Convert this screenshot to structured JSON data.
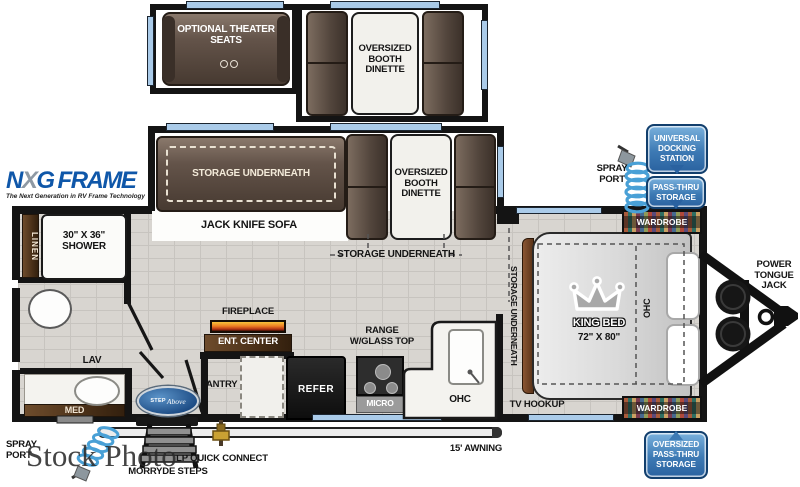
{
  "watermark": "Stock Photo",
  "brand": {
    "nxg_n": "N",
    "nxg_x": "X",
    "nxg_g": "G",
    "nxg_frame": "FRAME",
    "nxg_tagline": "The Next Generation in RV Frame Technology",
    "step": "STEP",
    "above": "Above",
    "colors": {
      "nxg_blue": "#0f57a9",
      "badge_blue": "#2d6da8",
      "window_blue": "#aacbe9",
      "sofa_brown": "#5d4d42",
      "wood_brown": "#4a3018",
      "wall_black": "#141414",
      "floor_gray": "#d8d5d0"
    }
  },
  "slides": {
    "theater": "OPTIONAL THEATER SEATS",
    "dinette_top": "OVERSIZED BOOTH DINETTE",
    "sofa_storage": "STORAGE UNDERNEATH",
    "sofa": "JACK KNIFE SOFA",
    "dinette_main": "OVERSIZED BOOTH DINETTE",
    "dinette_storage": "STORAGE UNDERNEATH"
  },
  "bathroom": {
    "linen": "LINEN",
    "shower": "30\" X 36\" SHOWER",
    "lav": "LAV",
    "med": "MED"
  },
  "kitchen": {
    "fireplace": "FIREPLACE",
    "ent_center": "ENT. CENTER",
    "pantry": "PANTRY",
    "refer": "REFER",
    "range": "RANGE W/GLASS TOP",
    "micro": "MICRO",
    "ohc": "OHC"
  },
  "bedroom": {
    "bed": "KING BED",
    "bed_size": "72\" X 80\"",
    "ohc": "OHC",
    "wardrobe_top": "WARDROBE",
    "wardrobe_bottom": "WARDROBE",
    "storage": "STORAGE UNDERNEATH",
    "tv": "TV HOOKUP"
  },
  "badges": {
    "docking": "UNIVERSAL DOCKING STATION",
    "passthru": "PASS-THRU STORAGE",
    "oversized_passthru": "OVERSIZED PASS-THRU STORAGE"
  },
  "exterior": {
    "spray_right": "SPRAY PORT",
    "spray_left": "SPRAY PORT",
    "tongue_jack": "POWER TONGUE JACK",
    "lp": "LP QUICK CONNECT",
    "steps": "MORRYDE STEPS",
    "awning": "15' AWNING"
  }
}
